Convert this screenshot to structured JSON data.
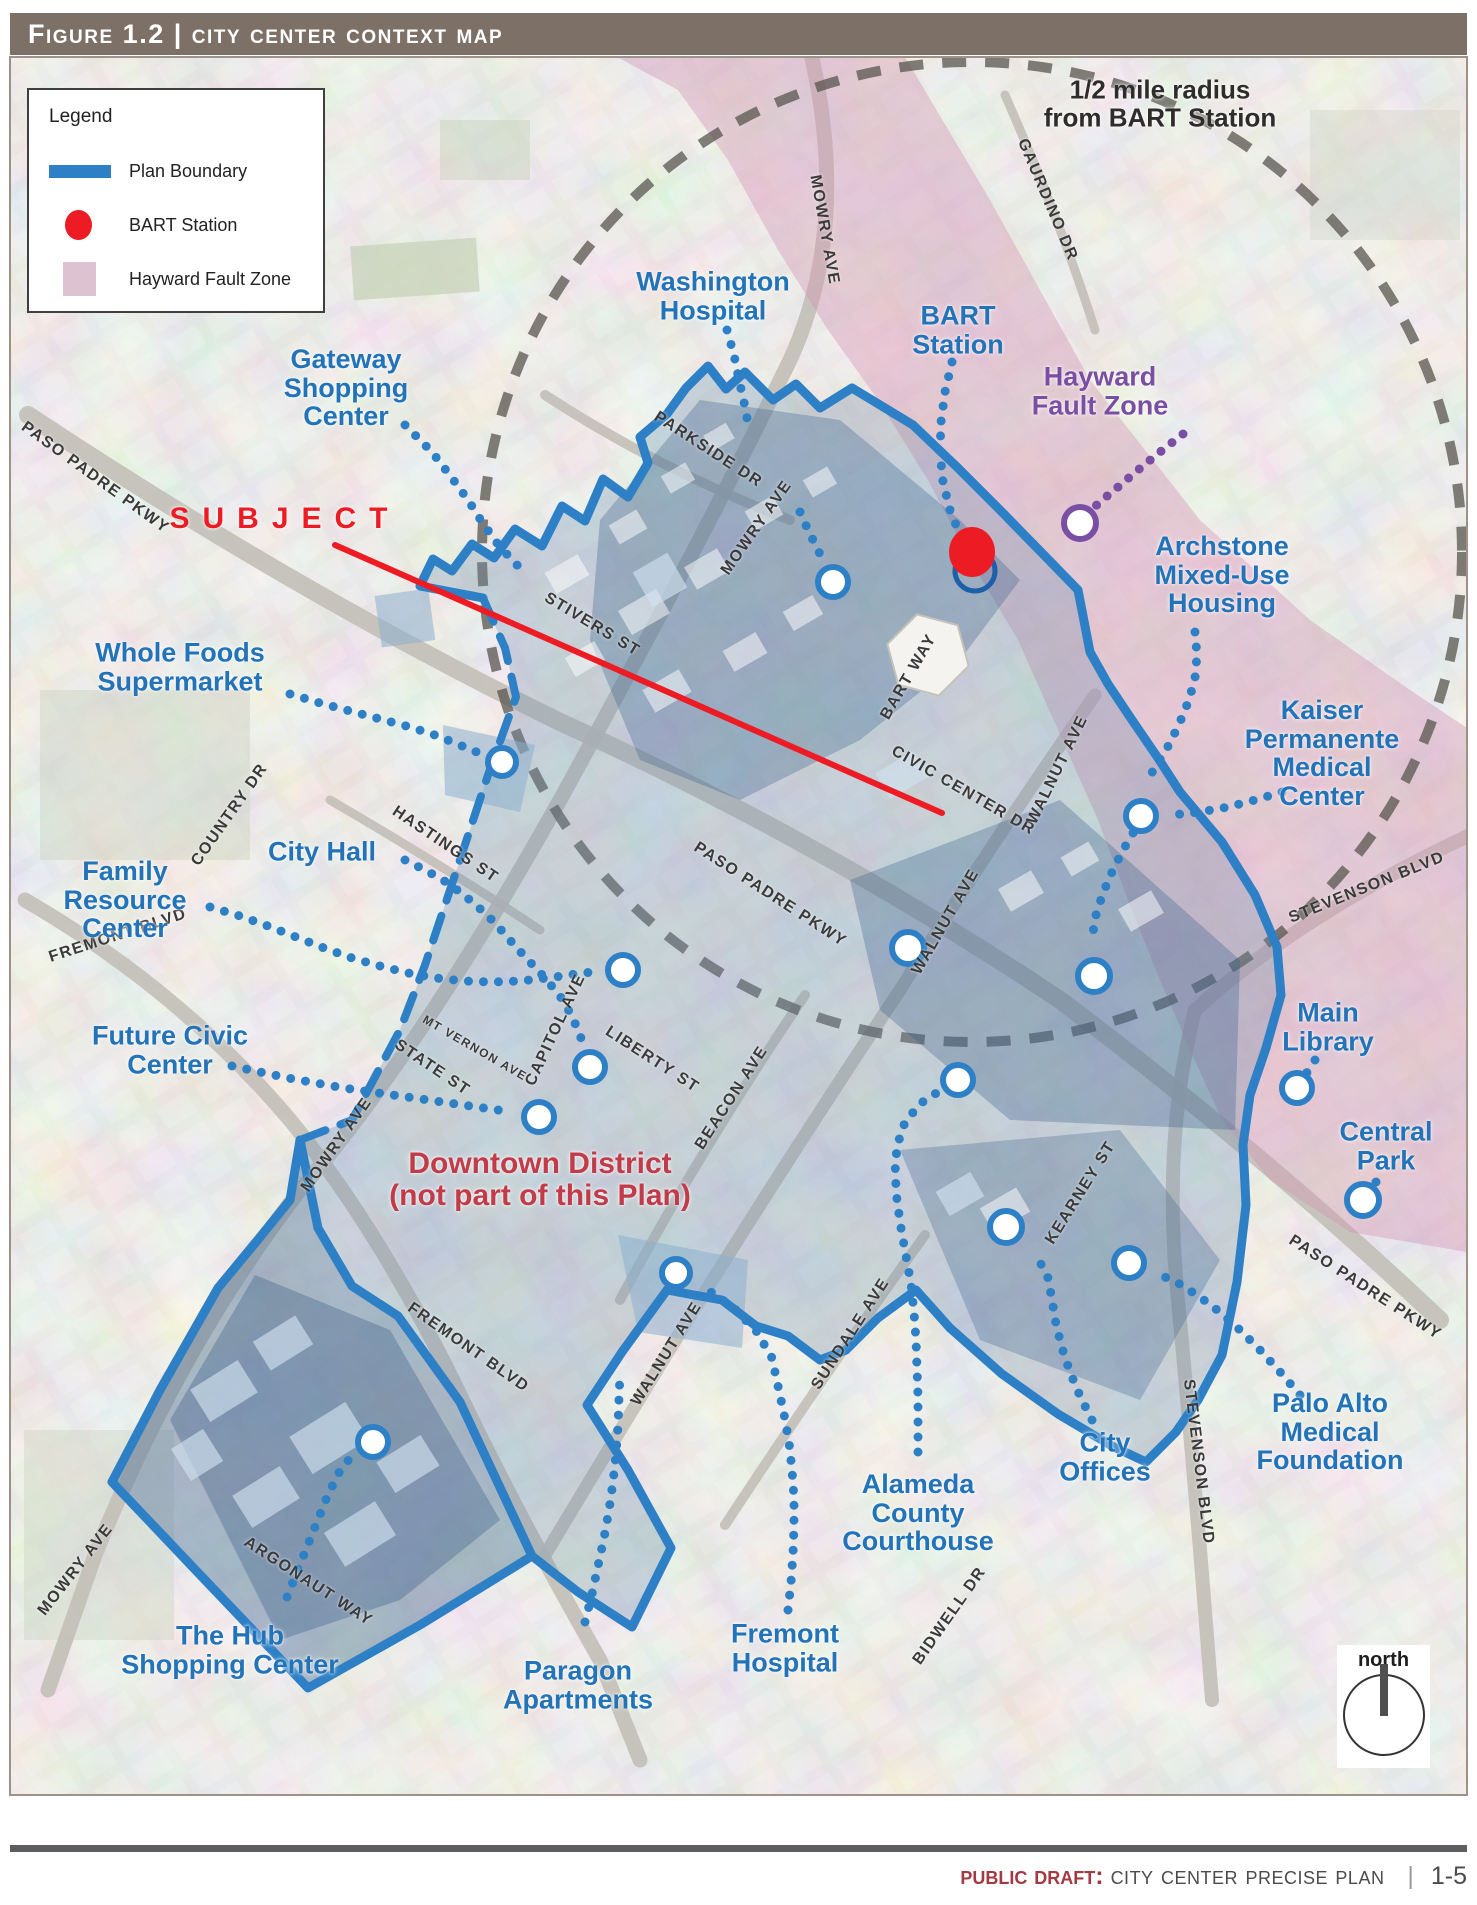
{
  "colors": {
    "header_bg": "#7d7066",
    "footer_bar": "#5d5e60",
    "draft_red": "#a13a42",
    "boundary": "#2e80c6",
    "label_blue": "#2273b8",
    "purple": "#7a4fa3",
    "red": "#ed1c24",
    "downtown_red": "#c23b49",
    "fault_pink": "#d496b4"
  },
  "header": {
    "title": "Figure 1.2 | City Center Context Map"
  },
  "legend": {
    "title": "Legend",
    "items": [
      {
        "swatch": "line",
        "label": "Plan Boundary"
      },
      {
        "swatch": "dot",
        "label": "BART Station"
      },
      {
        "swatch": "box",
        "label": "Hayward Fault Zone"
      }
    ]
  },
  "north": {
    "label": "north"
  },
  "footer": {
    "draft_label": "Public Draft:",
    "title": "City Center Precise Plan",
    "page": "1-5"
  },
  "map": {
    "place_labels": [
      {
        "id": "half-mile-note",
        "t": "1/2 mile radius\nfrom BART Station",
        "x": 1160,
        "y": 104,
        "c": "dark"
      },
      {
        "id": "washington-hospital",
        "t": "Washington\nHospital",
        "x": 713,
        "y": 296,
        "c": "blue"
      },
      {
        "id": "bart-station",
        "t": "BART\nStation",
        "x": 958,
        "y": 330,
        "c": "blue"
      },
      {
        "id": "hayward-fault-zone",
        "t": "Hayward\nFault Zone",
        "x": 1100,
        "y": 391,
        "c": "purple"
      },
      {
        "id": "gateway-shopping-center",
        "t": "Gateway\nShopping\nCenter",
        "x": 346,
        "y": 388,
        "c": "blue"
      },
      {
        "id": "subject",
        "t": "SUBJECT",
        "x": 285,
        "y": 519,
        "c": "red",
        "cls": "subject"
      },
      {
        "id": "archstone-housing",
        "t": "Archstone\nMixed-Use\nHousing",
        "x": 1222,
        "y": 575,
        "c": "blue"
      },
      {
        "id": "kaiser-medical-center",
        "t": "Kaiser\nPermanente\nMedical\nCenter",
        "x": 1322,
        "y": 753,
        "c": "blue"
      },
      {
        "id": "whole-foods",
        "t": "Whole Foods\nSupermarket",
        "x": 180,
        "y": 667,
        "c": "blue"
      },
      {
        "id": "city-hall",
        "t": "City Hall",
        "x": 322,
        "y": 852,
        "c": "blue"
      },
      {
        "id": "family-resource-center",
        "t": "Family\nResource\nCenter",
        "x": 125,
        "y": 900,
        "c": "blue"
      },
      {
        "id": "future-civic-center",
        "t": "Future Civic\nCenter",
        "x": 170,
        "y": 1050,
        "c": "blue"
      },
      {
        "id": "main-library",
        "t": "Main\nLibrary",
        "x": 1328,
        "y": 1027,
        "c": "blue"
      },
      {
        "id": "central-park",
        "t": "Central\nPark",
        "x": 1386,
        "y": 1146,
        "c": "blue"
      },
      {
        "id": "downtown-district",
        "t": "Downtown District\n(not part of this Plan)",
        "x": 540,
        "y": 1180,
        "c": "darkred"
      },
      {
        "id": "the-hub",
        "t": "The Hub\nShopping Center",
        "x": 230,
        "y": 1650,
        "c": "blue"
      },
      {
        "id": "paragon-apartments",
        "t": "Paragon\nApartments",
        "x": 578,
        "y": 1685,
        "c": "blue"
      },
      {
        "id": "fremont-hospital",
        "t": "Fremont\nHospital",
        "x": 785,
        "y": 1648,
        "c": "blue"
      },
      {
        "id": "alameda-courthouse",
        "t": "Alameda\nCounty\nCourthouse",
        "x": 918,
        "y": 1513,
        "c": "blue"
      },
      {
        "id": "city-offices",
        "t": "City\nOffices",
        "x": 1105,
        "y": 1457,
        "c": "blue"
      },
      {
        "id": "palo-alto-medical",
        "t": "Palo Alto\nMedical\nFoundation",
        "x": 1330,
        "y": 1432,
        "c": "blue"
      }
    ],
    "street_labels": [
      {
        "t": "BLVD",
        "x": 292,
        "y": 158,
        "r": -38
      },
      {
        "t": "PASO PADRE PKWY",
        "x": 95,
        "y": 478,
        "r": 36
      },
      {
        "t": "MOWRY AVE",
        "x": 824,
        "y": 230,
        "r": 80
      },
      {
        "t": "GAURDINO DR",
        "x": 1047,
        "y": 200,
        "r": 67
      },
      {
        "t": "PARKSIDE DR",
        "x": 708,
        "y": 450,
        "r": 33
      },
      {
        "t": "STIVERS ST",
        "x": 592,
        "y": 625,
        "r": 31
      },
      {
        "t": "MOWRY AVE",
        "x": 757,
        "y": 528,
        "r": -55
      },
      {
        "t": "BART WAY",
        "x": 909,
        "y": 677,
        "r": -60
      },
      {
        "t": "CIVIC CENTER DR",
        "x": 963,
        "y": 791,
        "r": 30
      },
      {
        "t": "WALNUT AVE",
        "x": 1058,
        "y": 770,
        "r": -64
      },
      {
        "t": "WALNUT AVE",
        "x": 946,
        "y": 922,
        "r": -60
      },
      {
        "t": "HASTINGS ST",
        "x": 445,
        "y": 845,
        "r": 34
      },
      {
        "t": "COUNTRY DR",
        "x": 230,
        "y": 815,
        "r": -55
      },
      {
        "t": "MT VERNON AVE",
        "x": 475,
        "y": 1048,
        "r": 30,
        "s": 12
      },
      {
        "t": "STATE ST",
        "x": 432,
        "y": 1068,
        "r": 34
      },
      {
        "t": "CAPITOL AVE",
        "x": 556,
        "y": 1030,
        "r": -65
      },
      {
        "t": "LIBERTY ST",
        "x": 652,
        "y": 1060,
        "r": 33
      },
      {
        "t": "BEACON AVE",
        "x": 732,
        "y": 1098,
        "r": -57
      },
      {
        "t": "FREMONT BLVD",
        "x": 118,
        "y": 936,
        "r": -18
      },
      {
        "t": "MOWRY AVE",
        "x": 337,
        "y": 1145,
        "r": -55
      },
      {
        "t": "STEVENSON BLVD",
        "x": 1367,
        "y": 888,
        "r": -22
      },
      {
        "t": "PASO PADRE PKWY",
        "x": 770,
        "y": 895,
        "r": 33
      },
      {
        "t": "FREMONT BLVD",
        "x": 468,
        "y": 1348,
        "r": 35
      },
      {
        "t": "ARGONAUT WAY",
        "x": 308,
        "y": 1582,
        "r": 33
      },
      {
        "t": "MOWRY AVE",
        "x": 76,
        "y": 1570,
        "r": -52
      },
      {
        "t": "SUNDALE AVE",
        "x": 851,
        "y": 1334,
        "r": -57
      },
      {
        "t": "WALNUT AVE",
        "x": 667,
        "y": 1354,
        "r": -58
      },
      {
        "t": "KEARNEY ST",
        "x": 1081,
        "y": 1193,
        "r": -58
      },
      {
        "t": "STEVENSON BLVD",
        "x": 1198,
        "y": 1462,
        "r": 83
      },
      {
        "t": "BIDWELL DR",
        "x": 950,
        "y": 1616,
        "r": -55
      },
      {
        "t": "PASO PADRE PKWY",
        "x": 1365,
        "y": 1288,
        "r": 33
      }
    ]
  }
}
